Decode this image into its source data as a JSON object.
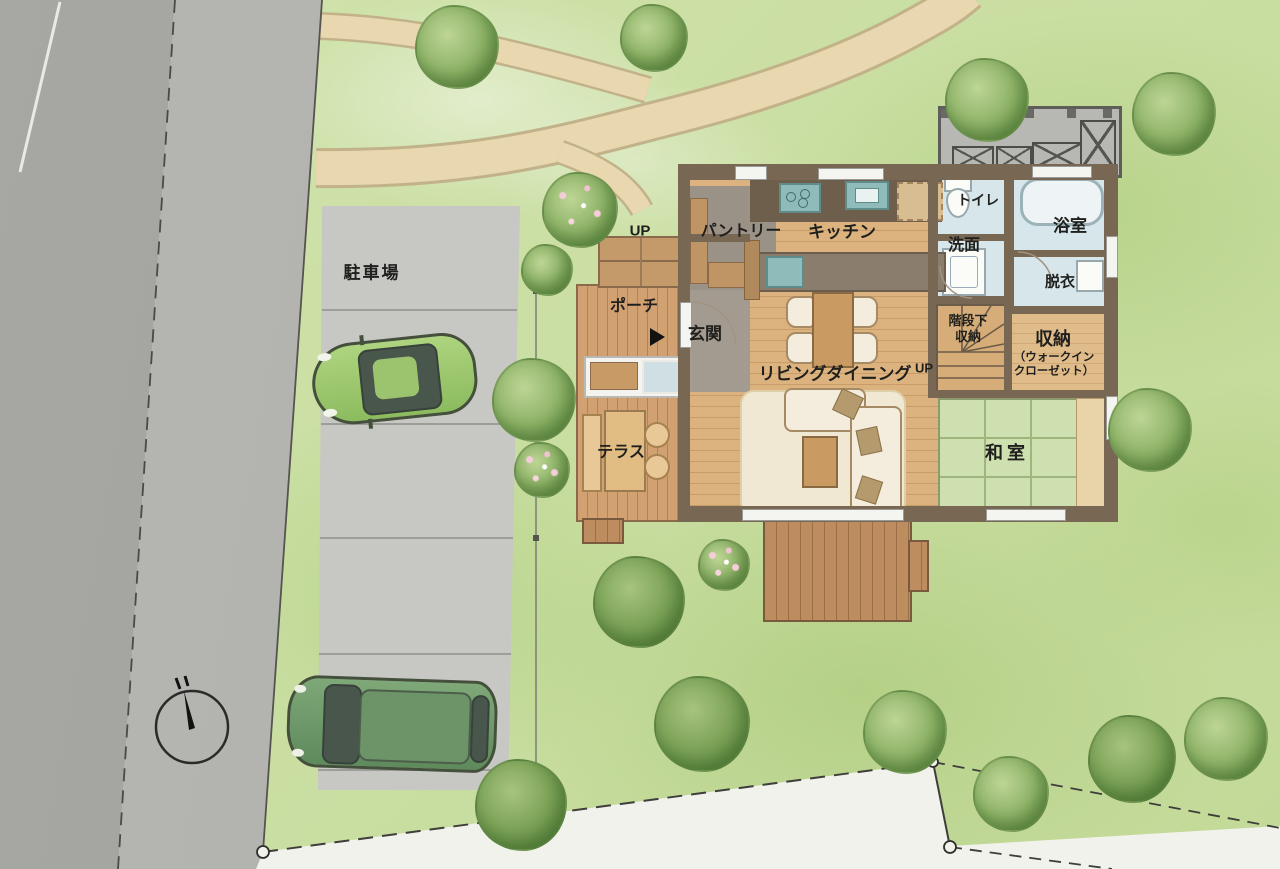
{
  "labels": {
    "parking": "駐車場",
    "up_porch": "UP",
    "porch": "ポーチ",
    "entrance": "玄関",
    "pantry": "パントリー",
    "kitchen": "キッチン",
    "toilet": "トイレ",
    "washroom": "洗面",
    "bathroom": "浴室",
    "dressing": "脱衣",
    "living_dining": "リビングダイニング",
    "up_stairs": "UP",
    "under_stair_l1": "階段下",
    "under_stair_l2": "収納",
    "storage": "収納",
    "storage_sub_l1": "（ウォークイン",
    "storage_sub_l2": "クローゼット）",
    "japanese_room": "和室",
    "terrace": "テラス"
  },
  "colors": {
    "lawn": "#c8de9f",
    "road": "#a0a09c",
    "sidewalk": "#b2b2ae",
    "parking": "#c7c7c3",
    "path": "#e7d6ad",
    "wood_floor": "#dcb37e",
    "deck": "#bd8d60",
    "wall": "#786753",
    "wet_floor": "#d6e6ea",
    "tatami": "#cfe0b0",
    "rug": "#f1e8d4",
    "tree_green": "#8fb468",
    "car_light_green": "#9ecb72",
    "car_dark_green": "#6f9468"
  }
}
